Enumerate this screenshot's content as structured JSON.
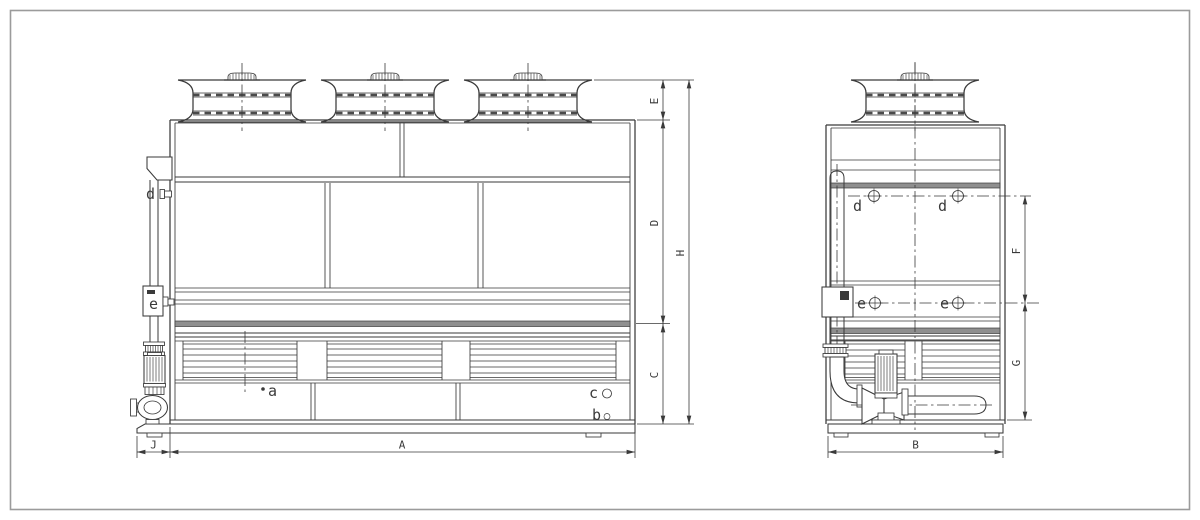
{
  "front_view": {
    "dims": {
      "E": "E",
      "D": "D",
      "C": "C",
      "H": "H",
      "A": "A",
      "J": "J"
    },
    "labels": {
      "a": "a",
      "b": "b",
      "c": "c",
      "d": "d",
      "e": "e"
    }
  },
  "side_view": {
    "dims": {
      "F": "F",
      "G": "G",
      "B": "B"
    },
    "labels": {
      "d_left": "d",
      "d_right": "d",
      "e_left": "e",
      "e_right": "e"
    }
  },
  "colors": {
    "line": "#3a3a3a",
    "band_fill": "#8f8f8f",
    "frame": "#9b9b9b",
    "background": "#ffffff"
  }
}
